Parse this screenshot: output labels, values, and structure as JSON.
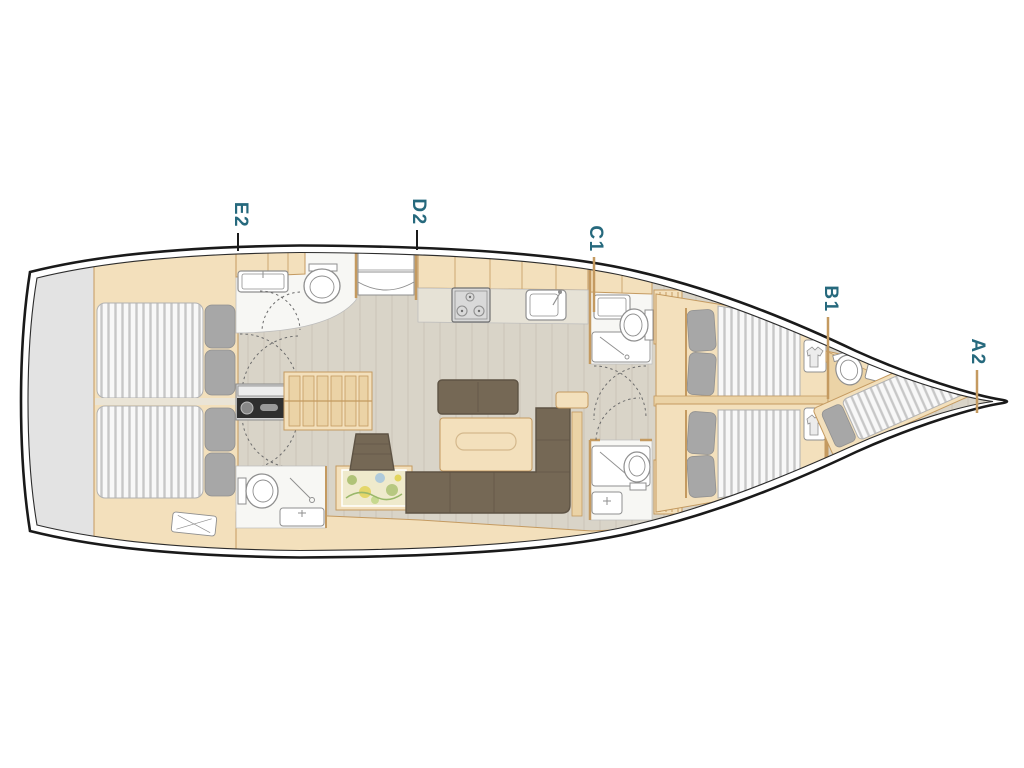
{
  "floorplan": {
    "cabin_labels": [
      {
        "id": "E2",
        "text": "E2"
      },
      {
        "id": "D2",
        "text": "D2"
      },
      {
        "id": "C1",
        "text": "C1"
      },
      {
        "id": "B1",
        "text": "B1"
      },
      {
        "id": "A2",
        "text": "A2"
      }
    ],
    "colors": {
      "label_teal": "#26697d",
      "hull_line": "#1a1a1a",
      "platform_gray": "#e3e3e3",
      "wood_light": "#f3e0bc",
      "wood_mid": "#ebd3a6",
      "wood_border": "#c49a60",
      "floor": "#d9d4c8",
      "sofa_brown": "#756855",
      "sofa_border": "#5e5344",
      "pillow_gray": "#a7a7a7",
      "mattress_white": "#f8f8f8",
      "mattress_stripe": "#c7c7c7",
      "fixture_stroke": "#8f8f8f",
      "map_base": "#efeacc",
      "map_green": "#a9bf6e",
      "map_yellow": "#e2d45e",
      "map_blue": "#a9c8dd"
    }
  }
}
